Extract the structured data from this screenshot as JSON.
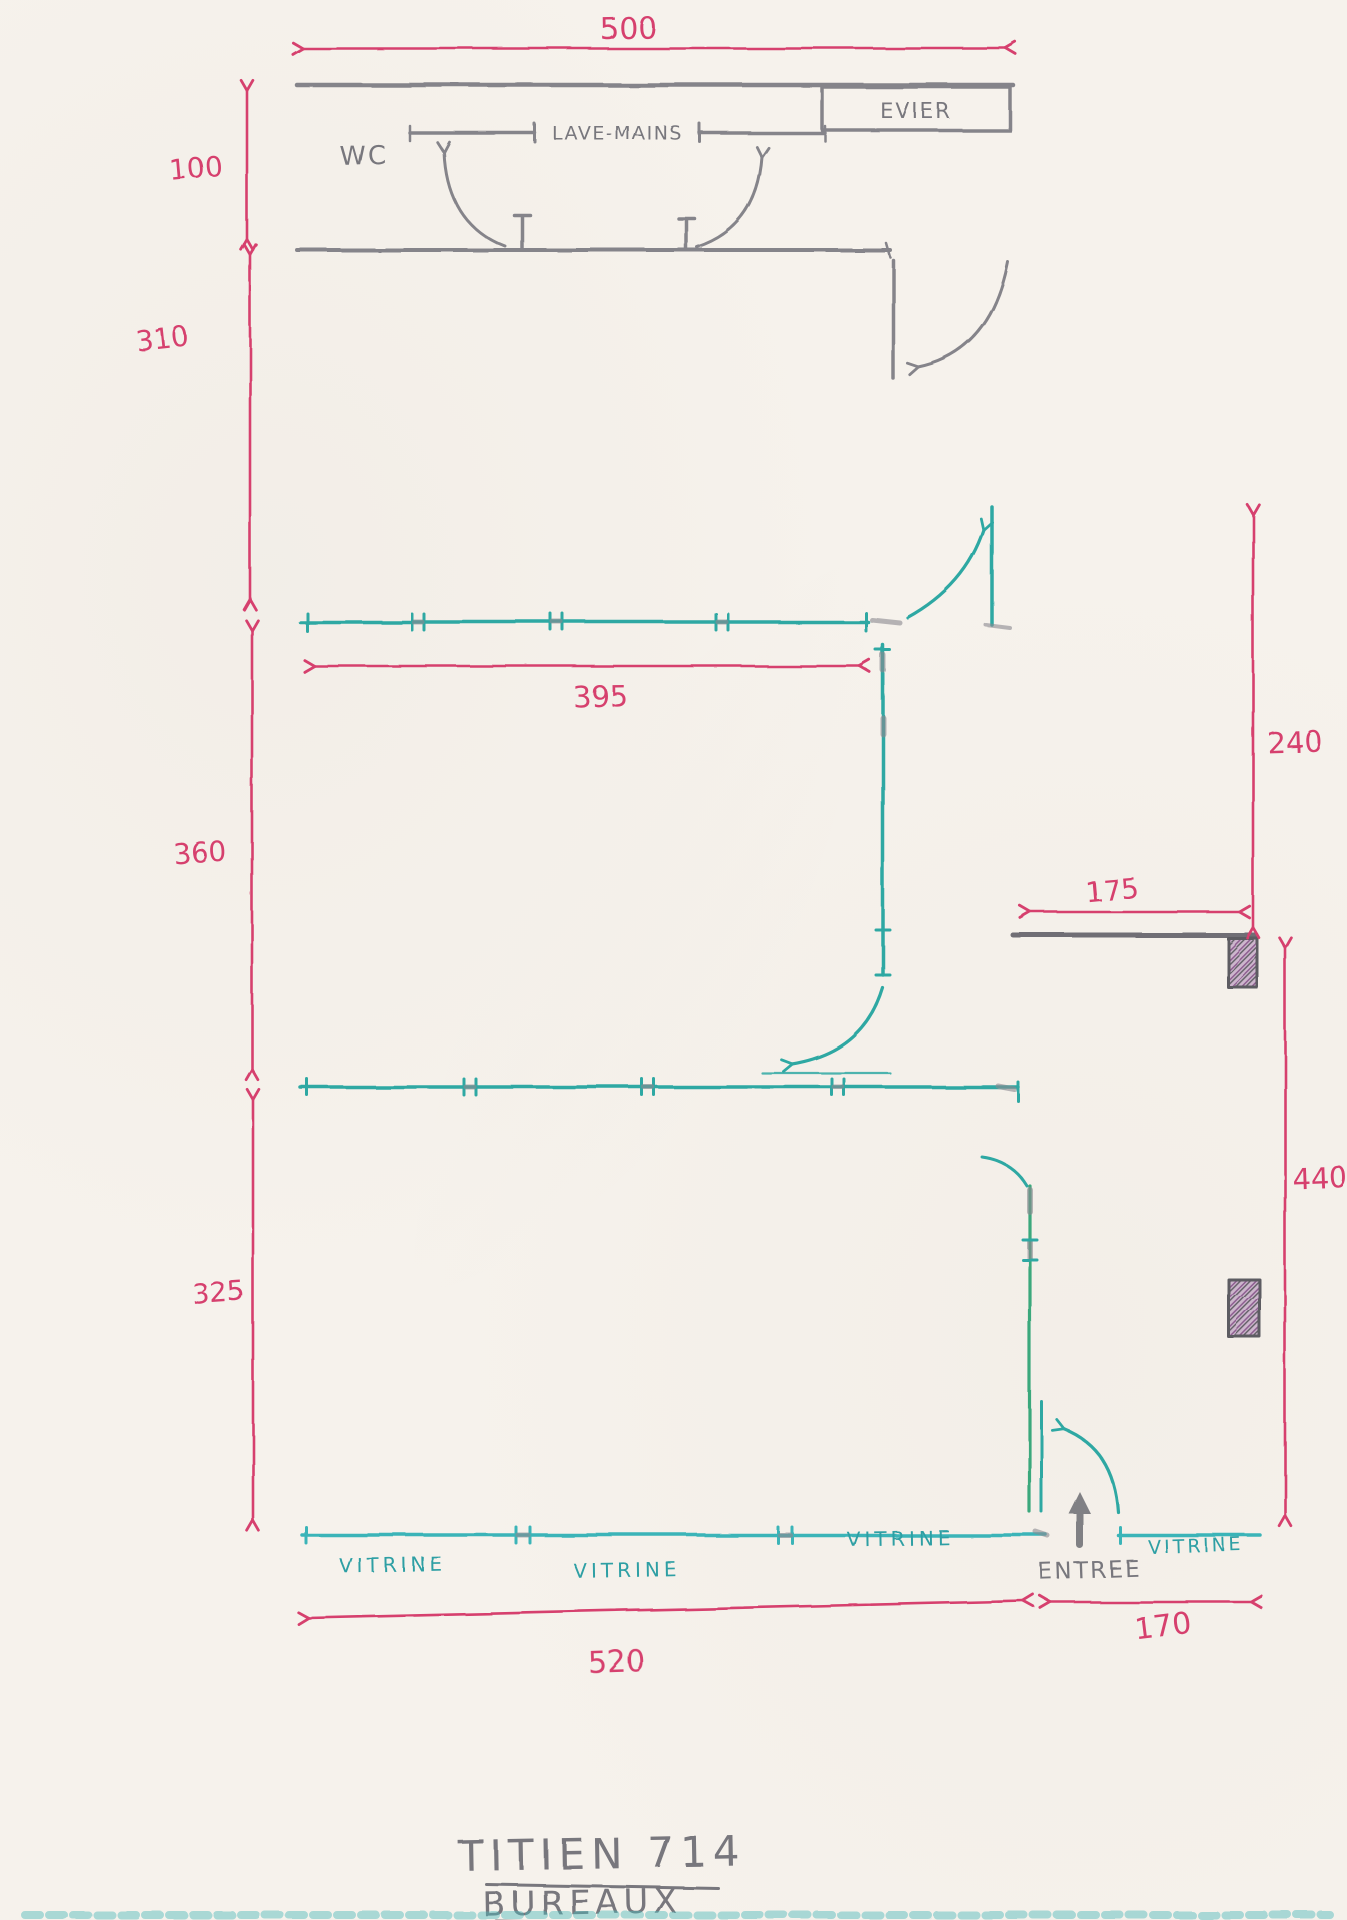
{
  "document": {
    "type": "hand-drawn floor plan sketch",
    "title": {
      "line1": "TITIEN 714",
      "line2": "BUREAUX"
    }
  },
  "labels": {
    "wc": "WC",
    "lave_mains": "LAVE-MAINS",
    "evier": "EVIER",
    "entree": "ENTREE"
  },
  "vitrines": [
    "VITRINE",
    "VITRINE",
    "VITRINE",
    "VITRINE"
  ],
  "dimensions": {
    "width_total": "500",
    "wc_depth": "100",
    "zone1_depth": "310",
    "zone2_depth": "360",
    "zone2_width": "395",
    "zone3_depth": "325",
    "right_upper_height": "240",
    "recess_width": "175",
    "right_lower_height": "440",
    "front_left_width": "520",
    "front_right_width": "170"
  },
  "colors": {
    "paper": "#f6f2ec",
    "pencil_gray": "#78777d",
    "dimension_pink": "#d6416e",
    "partition_teal": "#2fa8a3",
    "door_green": "#3aa87c",
    "wall_purple": "#97689f"
  }
}
